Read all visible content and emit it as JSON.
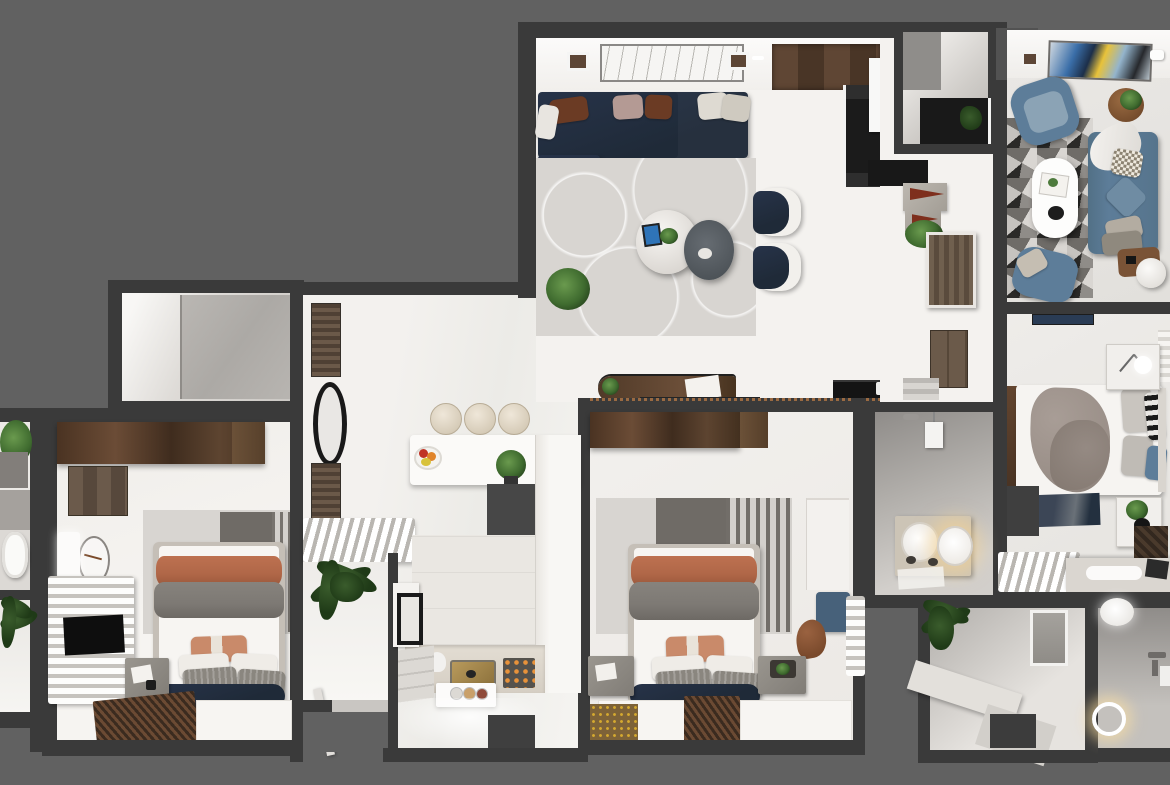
{
  "meta": {
    "scene": "top-down 3D render of an apartment floor plan",
    "visible_text": "none"
  },
  "palette": {
    "bg": "#616161",
    "wall": "#3a3a3a",
    "floor-white": "#f4f2ef",
    "floor-gray": "#b7b4b0",
    "rug-light": "#d8d5d1",
    "rug-dark": "#6f6b66",
    "navy": "#1f2a38",
    "slate-blue": "#5d7d99",
    "terracotta": "#b06748",
    "gray-fabric": "#7d7974",
    "plant-green": "#3f6b2f",
    "wood-dark": "#4a3322",
    "brass": "#b89a5c",
    "copper": "#9a6a42",
    "glow": "#ffdf9e"
  },
  "rooms": [
    {
      "id": "living-room",
      "furniture": [
        "navy-l-shaped-sectional-sofa",
        "throw-pillows",
        "round-marble-coffee-table",
        "round-gray-side-table",
        "two-accent-chairs",
        "swirl-pattern-area-rug",
        "potted-plant",
        "framed-wall-art",
        "ceiling-speakers",
        "wood-console-desk",
        "black-media-cabinet",
        "entry-wood-floor",
        "dark-shoe-cabinet",
        "open-white-door"
      ]
    },
    {
      "id": "lounge-top-right",
      "furniture": [
        "slate-blue-sofa",
        "two-slate-blue-armchairs",
        "white-oval-coffee-table",
        "geometric-triangle-rug",
        "round-wood-side-table",
        "white-pouf",
        "abstract-wall-art",
        "white-throw-blanket",
        "checkered-pillow"
      ]
    },
    {
      "id": "entry-hall",
      "furniture": [
        "closet-nook",
        "black-display-shelf",
        "red-cone-decor",
        "boxwood-plant-ball",
        "wooden-slat-door",
        "tall-wood-cabinet"
      ]
    },
    {
      "id": "right-bedroom",
      "furniture": [
        "double-bed",
        "draped-gray-blanket",
        "striped-and-blue-pillows",
        "wood-headboard-panel",
        "two-white-nightstands",
        "sphere-table-lamp",
        "potted-plant",
        "dark-blue-rug",
        "white-slatted-bench",
        "desk-with-keyboard",
        "herringbone-floor-patch"
      ]
    },
    {
      "id": "laundry-bathroom",
      "furniture": [
        "twin-round-basin-vanity",
        "shower-head",
        "wall-water-heater",
        "floor-mat",
        "warm-vanity-glow"
      ]
    },
    {
      "id": "center-bedroom",
      "furniture": [
        "dark-wood-wardrobe",
        "double-bed",
        "terracotta-and-gray-bedding",
        "two-gray-nightstands",
        "striped-gray-rug",
        "white-shelf-unit",
        "blue-ottoman",
        "brown-draped-cloth",
        "white-slatted-dresser",
        "brown-striped-runner-rug",
        "gold-dotted-mat"
      ]
    },
    {
      "id": "kitchen",
      "furniture": [
        "three-round-bar-stools",
        "white-breakfast-bar",
        "fruit-bowl",
        "potted-plant",
        "tall-white-cabinet-column",
        "brass-sink",
        "cooktop-with-burners",
        "white-kettle",
        "island-counter-with-plates",
        "black-framed-cabinet",
        "side-steps"
      ]
    },
    {
      "id": "hallway",
      "furniture": [
        "brown-wall-panels",
        "black-oval-mirror",
        "white-slatted-bench"
      ]
    },
    {
      "id": "vestibule",
      "furniture": [
        "spiky-potted-plant",
        "open-entry-door",
        "threshold"
      ]
    },
    {
      "id": "left-bedroom",
      "furniture": [
        "dark-wood-wardrobe",
        "double-bed",
        "terracotta-and-gray-bedding",
        "brown-wall-cabinet",
        "wall-clock",
        "white-light-panel",
        "white-slatted-dresser",
        "wall-tv",
        "gray-nightstand",
        "striped-gray-rug",
        "brown-striped-runner-rug"
      ]
    },
    {
      "id": "left-bathroom-strip",
      "furniture": [
        "potted-plant",
        "gray-vanity-desk",
        "toilet",
        "dark-spiky-plant"
      ]
    },
    {
      "id": "top-left-room",
      "furniture": [
        "gray-stone-slab-floor"
      ]
    },
    {
      "id": "bottom-right-room",
      "furniture": [
        "spiky-potted-plant",
        "wall-panel-window",
        "l-shaped-ledge-bench"
      ]
    },
    {
      "id": "shower-room",
      "furniture": [
        "sphere-pendant-light",
        "glowing-floor-drain-ring",
        "shower-fixtures"
      ]
    }
  ]
}
